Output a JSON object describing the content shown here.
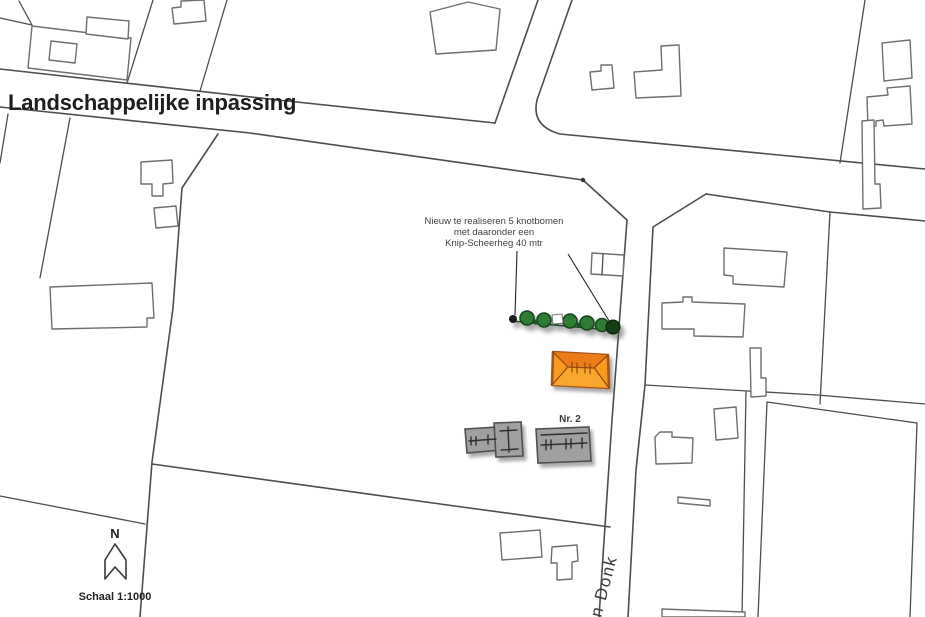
{
  "title": "Landschappelijke inpassing",
  "annotation": {
    "line1": "Nieuw te realiseren 5 knotbomen",
    "line2": "met daaronder een",
    "line3": "Knip-Scheerheg 40 mtr"
  },
  "labels": {
    "building_number": "Nr. 2",
    "street_name": "n Donk",
    "north": "N",
    "scale": "Schaal 1:1000"
  },
  "colors": {
    "background": "#FFFFFF",
    "parcel_line": "#4D4D4D",
    "building_outline": "#6E6E6E",
    "new_building_fill": "#F79A1E",
    "new_building_border": "#A8531A",
    "new_building_roof_top": "#EC7B19",
    "new_building_roof_bottom": "#F9A62D",
    "new_building_roof_edge": "#8F4711",
    "existing_building_fill": "#A0A0A0",
    "existing_building_border": "#4F4F4F",
    "tree_fill": "#2E7D33",
    "tree_border": "#16451B",
    "tree_dark_blob": "#153F18",
    "hedge_line": "#2C4A28",
    "text_color": "#3F3F3F"
  }
}
